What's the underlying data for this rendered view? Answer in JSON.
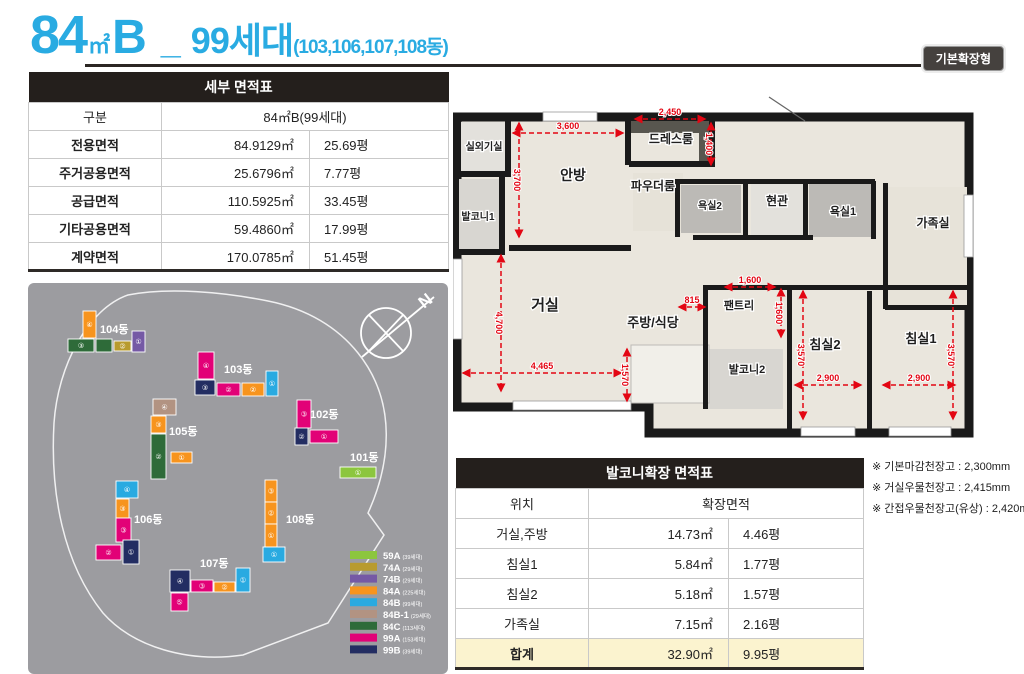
{
  "header": {
    "num": "84",
    "unit": "㎡",
    "type": "B",
    "sep": "_",
    "households": "99세대",
    "buildings": "(103,106,107,108동)",
    "badge": "기본확장형",
    "accent_color": "#29abe2"
  },
  "detail_table": {
    "title": "세부 면적표",
    "col_header": "구분",
    "col_value_header": "84㎡B(99세대)",
    "rows": [
      {
        "label": "전용면적",
        "sqm": "84.9129㎡",
        "pyeong": "25.69평"
      },
      {
        "label": "주거공용면적",
        "sqm": "25.6796㎡",
        "pyeong": "7.77평"
      },
      {
        "label": "공급면적",
        "sqm": "110.5925㎡",
        "pyeong": "33.45평"
      },
      {
        "label": "기타공용면적",
        "sqm": "59.4860㎡",
        "pyeong": "17.99평"
      },
      {
        "label": "계약면적",
        "sqm": "170.0785㎡",
        "pyeong": "51.45평"
      }
    ]
  },
  "balcony_table": {
    "title": "발코니확장 면적표",
    "col_header": "위치",
    "col_value_header": "확장면적",
    "rows": [
      {
        "label": "거실,주방",
        "sqm": "14.73㎡",
        "pyeong": "4.46평"
      },
      {
        "label": "침실1",
        "sqm": "5.84㎡",
        "pyeong": "1.77평"
      },
      {
        "label": "침실2",
        "sqm": "5.18㎡",
        "pyeong": "1.57평"
      },
      {
        "label": "가족실",
        "sqm": "7.15㎡",
        "pyeong": "2.16평"
      }
    ],
    "total": {
      "label": "합계",
      "sqm": "32.90㎡",
      "pyeong": "9.95평"
    }
  },
  "notes": [
    "※ 기본마감천장고 : 2,300mm",
    "※ 거실우물천장고 : 2,415mm",
    "※ 간접우물천장고(유상) : 2,420mm"
  ],
  "floorplan": {
    "dim_color": "#e30613",
    "rooms": [
      {
        "label": "실외기실",
        "x": 31,
        "y": 55,
        "fs": 10
      },
      {
        "label": "발코니1",
        "x": 25,
        "y": 125,
        "fs": 10
      },
      {
        "label": "안방",
        "x": 120,
        "y": 85,
        "fs": 14
      },
      {
        "label": "드레스룸",
        "x": 218,
        "y": 48,
        "fs": 12
      },
      {
        "label": "파우더룸",
        "x": 200,
        "y": 95,
        "fs": 12
      },
      {
        "label": "욕실2",
        "x": 257,
        "y": 114,
        "fs": 10
      },
      {
        "label": "현관",
        "x": 324,
        "y": 110,
        "fs": 12
      },
      {
        "label": "욕실1",
        "x": 390,
        "y": 120,
        "fs": 11
      },
      {
        "label": "가족실",
        "x": 480,
        "y": 132,
        "fs": 12
      },
      {
        "label": "거실",
        "x": 92,
        "y": 215,
        "fs": 15
      },
      {
        "label": "주방/식당",
        "x": 200,
        "y": 232,
        "fs": 13
      },
      {
        "label": "팬트리",
        "x": 286,
        "y": 214,
        "fs": 11
      },
      {
        "label": "발코니2",
        "x": 294,
        "y": 278,
        "fs": 11
      },
      {
        "label": "침실2",
        "x": 372,
        "y": 254,
        "fs": 13
      },
      {
        "label": "침실1",
        "x": 468,
        "y": 248,
        "fs": 13
      }
    ],
    "dims": [
      {
        "t": "3,600",
        "o": "h",
        "y": 38,
        "x1": 60,
        "x2": 170
      },
      {
        "t": "3,700",
        "o": "v",
        "x": 66,
        "y1": 28,
        "y2": 142
      },
      {
        "t": "2,450",
        "o": "h",
        "y": 24,
        "x1": 182,
        "x2": 252
      },
      {
        "t": "1,400",
        "o": "v",
        "x": 258,
        "y1": 28,
        "y2": 70
      },
      {
        "t": "4,700",
        "o": "v",
        "x": 48,
        "y1": 160,
        "y2": 296
      },
      {
        "t": "4,465",
        "o": "h",
        "y": 278,
        "x1": 10,
        "x2": 168
      },
      {
        "t": "1,570",
        "o": "v",
        "x": 174,
        "y1": 254,
        "y2": 306
      },
      {
        "t": "815",
        "o": "h",
        "y": 212,
        "x1": 226,
        "x2": 252
      },
      {
        "t": "1,600",
        "o": "h",
        "y": 192,
        "x1": 272,
        "x2": 322
      },
      {
        "t": "1,600",
        "o": "v",
        "x": 328,
        "y1": 194,
        "y2": 242
      },
      {
        "t": "3,570",
        "o": "v",
        "x": 350,
        "y1": 196,
        "y2": 324
      },
      {
        "t": "2,900",
        "o": "h",
        "y": 290,
        "x1": 342,
        "x2": 408
      },
      {
        "t": "3,570",
        "o": "v",
        "x": 500,
        "y1": 196,
        "y2": 324
      },
      {
        "t": "2,900",
        "o": "h",
        "y": 290,
        "x1": 430,
        "x2": 502
      }
    ]
  },
  "sitemap": {
    "compass_letter": "N",
    "legend": [
      {
        "code": "59A",
        "note": "(39세대)",
        "color": "#8cc63e"
      },
      {
        "code": "74A",
        "note": "(29세대)",
        "color": "#b89b2e"
      },
      {
        "code": "74B",
        "note": "(29세대)",
        "color": "#7559a5"
      },
      {
        "code": "84A",
        "note": "(225세대)",
        "color": "#f7941e"
      },
      {
        "code": "84B",
        "note": "(99세대)",
        "color": "#29aae1"
      },
      {
        "code": "84B-1",
        "note": "(29세대)",
        "color": "#b29382"
      },
      {
        "code": "84C",
        "note": "(113세대)",
        "color": "#2e6b39"
      },
      {
        "code": "99A",
        "note": "(153세대)",
        "color": "#e20177"
      },
      {
        "code": "99B",
        "note": "(39세대)",
        "color": "#232d62"
      }
    ],
    "buildings": [
      {
        "label": "104동",
        "lx": 72,
        "ly": 50,
        "blocks": [
          [
            "84A",
            55,
            28,
            13,
            27,
            "④"
          ],
          [
            "84C",
            40,
            56,
            26,
            13,
            "③"
          ],
          [
            "84C",
            68,
            56,
            16,
            13,
            ""
          ],
          [
            "74A",
            86,
            58,
            17,
            10,
            "②"
          ],
          [
            "74B",
            104,
            48,
            13,
            21,
            "①"
          ]
        ]
      },
      {
        "label": "103동",
        "lx": 196,
        "ly": 90,
        "blocks": [
          [
            "99A",
            170,
            69,
            16,
            27,
            "④"
          ],
          [
            "99B",
            167,
            97,
            20,
            15,
            "③"
          ],
          [
            "99A",
            189,
            100,
            23,
            13,
            "②"
          ],
          [
            "84A",
            214,
            100,
            22,
            13,
            "②"
          ],
          [
            "84B",
            238,
            88,
            12,
            25,
            "①"
          ]
        ]
      },
      {
        "label": "102동",
        "lx": 282,
        "ly": 135,
        "blocks": [
          [
            "99A",
            269,
            117,
            14,
            28,
            "③"
          ],
          [
            "99B",
            267,
            145,
            13,
            17,
            "②"
          ],
          [
            "99A",
            282,
            147,
            28,
            13,
            "①"
          ]
        ]
      },
      {
        "label": "105동",
        "lx": 141,
        "ly": 152,
        "blocks": [
          [
            "84B-1",
            125,
            116,
            23,
            16,
            "④"
          ],
          [
            "84A",
            123,
            133,
            15,
            17,
            "③"
          ],
          [
            "84C",
            123,
            151,
            15,
            45,
            "②"
          ],
          [
            "84A",
            143,
            169,
            21,
            11,
            "①"
          ]
        ]
      },
      {
        "label": "101동",
        "lx": 322,
        "ly": 178,
        "blocks": [
          [
            "59A",
            312,
            184,
            36,
            11,
            "①"
          ]
        ]
      },
      {
        "label": "106동",
        "lx": 106,
        "ly": 240,
        "blocks": [
          [
            "84B",
            88,
            198,
            22,
            17,
            "④"
          ],
          [
            "84A",
            88,
            216,
            13,
            19,
            "③"
          ],
          [
            "99A",
            88,
            235,
            15,
            24,
            "③"
          ],
          [
            "99A",
            68,
            262,
            25,
            15,
            "②"
          ],
          [
            "99B",
            95,
            257,
            16,
            24,
            "①"
          ]
        ]
      },
      {
        "label": "107동",
        "lx": 172,
        "ly": 284,
        "blocks": [
          [
            "99B",
            142,
            287,
            20,
            22,
            "④"
          ],
          [
            "99A",
            163,
            297,
            22,
            12,
            "③"
          ],
          [
            "84A",
            186,
            299,
            21,
            10,
            "②"
          ],
          [
            "84B",
            208,
            285,
            14,
            24,
            "①"
          ],
          [
            "99A",
            143,
            310,
            17,
            18,
            "⑤"
          ]
        ]
      },
      {
        "label": "108동",
        "lx": 258,
        "ly": 240,
        "blocks": [
          [
            "84A",
            237,
            197,
            12,
            22,
            "③"
          ],
          [
            "84A",
            237,
            219,
            12,
            22,
            "②"
          ],
          [
            "84A",
            237,
            241,
            12,
            23,
            "①"
          ],
          [
            "84B",
            235,
            264,
            22,
            15,
            "①"
          ]
        ]
      }
    ]
  }
}
